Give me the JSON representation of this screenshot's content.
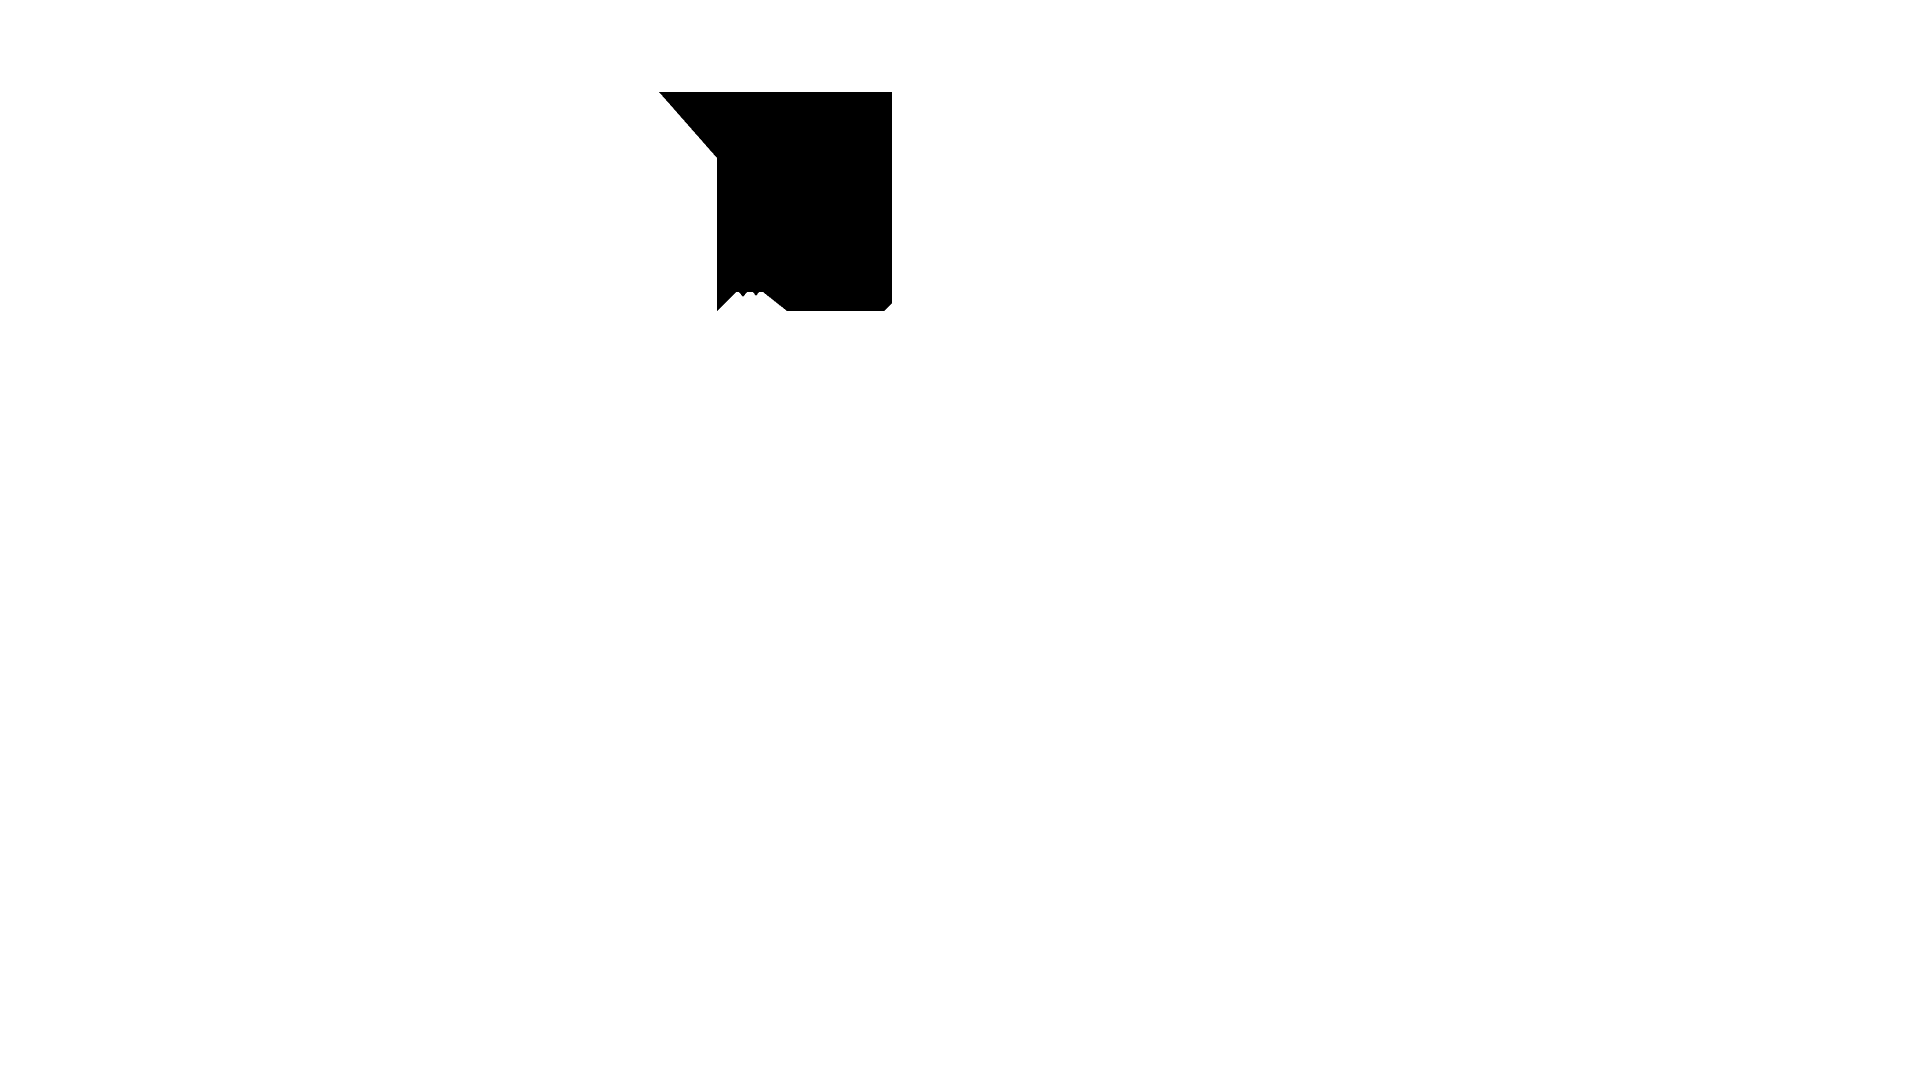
{
  "page": {
    "background_color": "#ffffff",
    "width_px": 1920,
    "height_px": 1080
  },
  "glyph": {
    "description": "single solid black angular glyph on an otherwise blank white screen; square body with a pointed wedge extending up-left from the top-left corner, a small beveled cut at the bottom-right corner, and a jagged twin-peak mountain-shaped white notch cut into the bottom edge",
    "fill_color": "#000000",
    "bounding_box": {
      "x": 659,
      "y": 92,
      "width": 233,
      "height": 219
    },
    "outline_points": "659,92 892,92 892,303 884,311 787,311 763,292 759,292 756,296 753,292 747,292 743,297 739,292 736,292 717,311 717,158"
  }
}
